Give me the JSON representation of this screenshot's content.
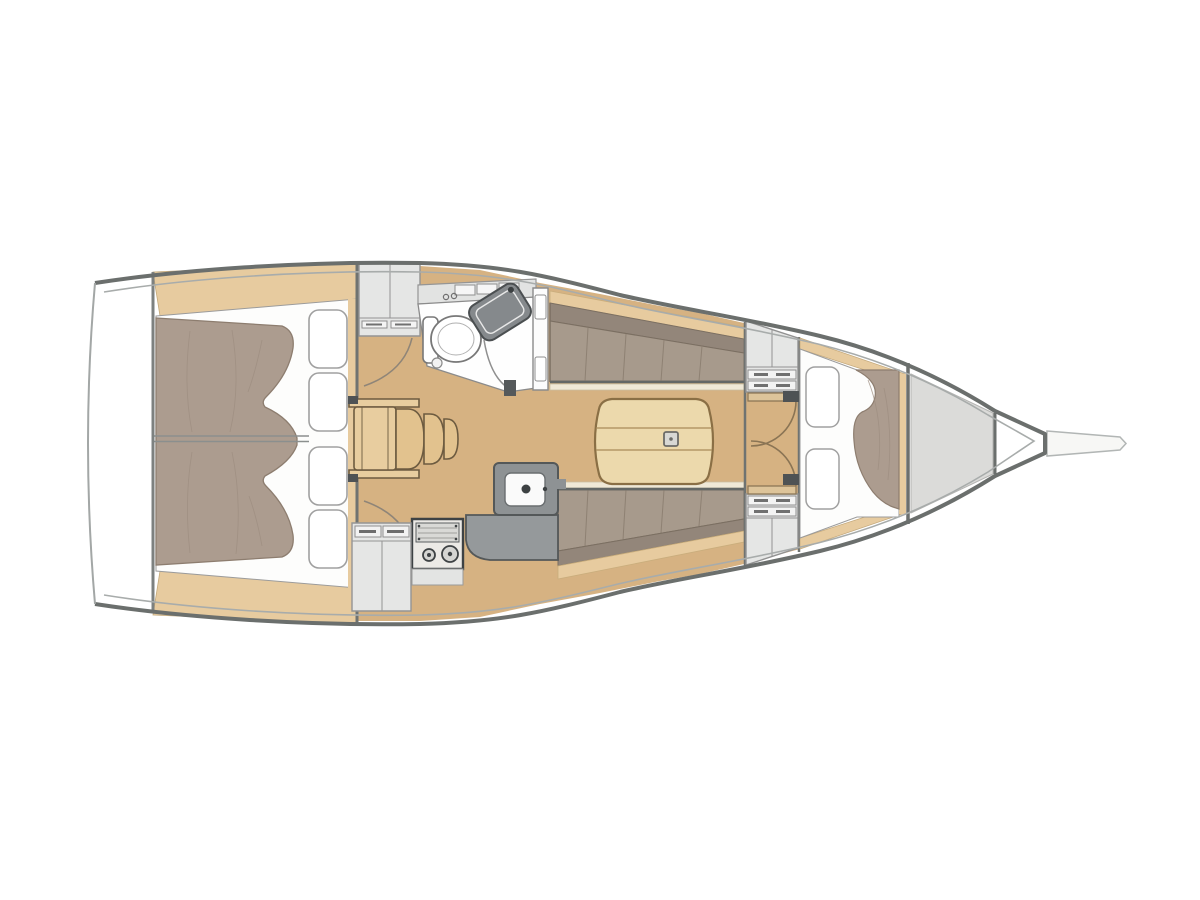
{
  "meta": {
    "title": "sailing-yacht-interior-floor-plan",
    "view": "top-down deck plan",
    "orientation": {
      "stern": "left",
      "bow": "right"
    }
  },
  "palette": {
    "white": "#ffffff",
    "hull_fill": "#ffffff",
    "hull_outline": "#6b6f6d",
    "sheer_line": "#a8acab",
    "transom_line": "#a3a7a6",
    "floor_wood": "#d6b282",
    "trim_wood": "#e7cb9f",
    "step_wood": "#e8cd9f",
    "step_wood_dark": "#e2c28e",
    "wood_edge": "#6d5b40",
    "table_wood": "#ecd9ac",
    "table_edge": "#8a6f45",
    "cushion_seat": "#a79a8c",
    "cushion_back": "#93867a",
    "cushion_edge": "#7b6f62",
    "blanket": "#ac9c8f",
    "blanket_edge": "#8d7d6f",
    "pillow": "#ffffff",
    "pillow_edge": "#a0a0a0",
    "fiddle": "#efe8d6",
    "locker_fill": "#e5e6e5",
    "locker_stroke": "#929292",
    "drawer_fill": "#f2f2f2",
    "galley_dark": "#8e9294",
    "galley_counter": "#95999b",
    "galley_stroke": "#545859",
    "stove_fill": "#eceae6",
    "stove_stroke": "#3e4244",
    "head_floor": "#fefefe",
    "head_stroke": "#8b8b8b",
    "sink_dark": "#85898c",
    "gray_zone": "#dbdbd9",
    "hinge_dark": "#4e5254",
    "door_arc": "#8a7454",
    "bowsprit_fill": "#f7f7f5",
    "centerline": "#8b8f8e"
  },
  "regions": {
    "transom": {
      "label": "stern transom"
    },
    "aft_cabin": {
      "label": "aft owner cabin",
      "pillows": 4,
      "beds": 1,
      "blanket_halves": 2
    },
    "companionway": {
      "label": "companionway steps",
      "treads": 4
    },
    "head": {
      "label": "head / bathroom",
      "toilet": 1,
      "sink": 1,
      "faucet_knobs": 2
    },
    "salon": {
      "label": "salon",
      "settees": 2,
      "table_leaves": 2
    },
    "galley": {
      "label": "galley",
      "burners": 2,
      "sinks": 1,
      "drawers": 2
    },
    "forward_bulkhead": {
      "label": "forward bulkhead with double doors",
      "doors": 2,
      "lockers": 2
    },
    "forward_cabin": {
      "label": "forward V-berth cabin",
      "pillows": 2,
      "beds": 1
    },
    "anchor_locker": {
      "label": "bow anchor locker"
    },
    "bowsprit": {
      "label": "bowsprit"
    }
  }
}
